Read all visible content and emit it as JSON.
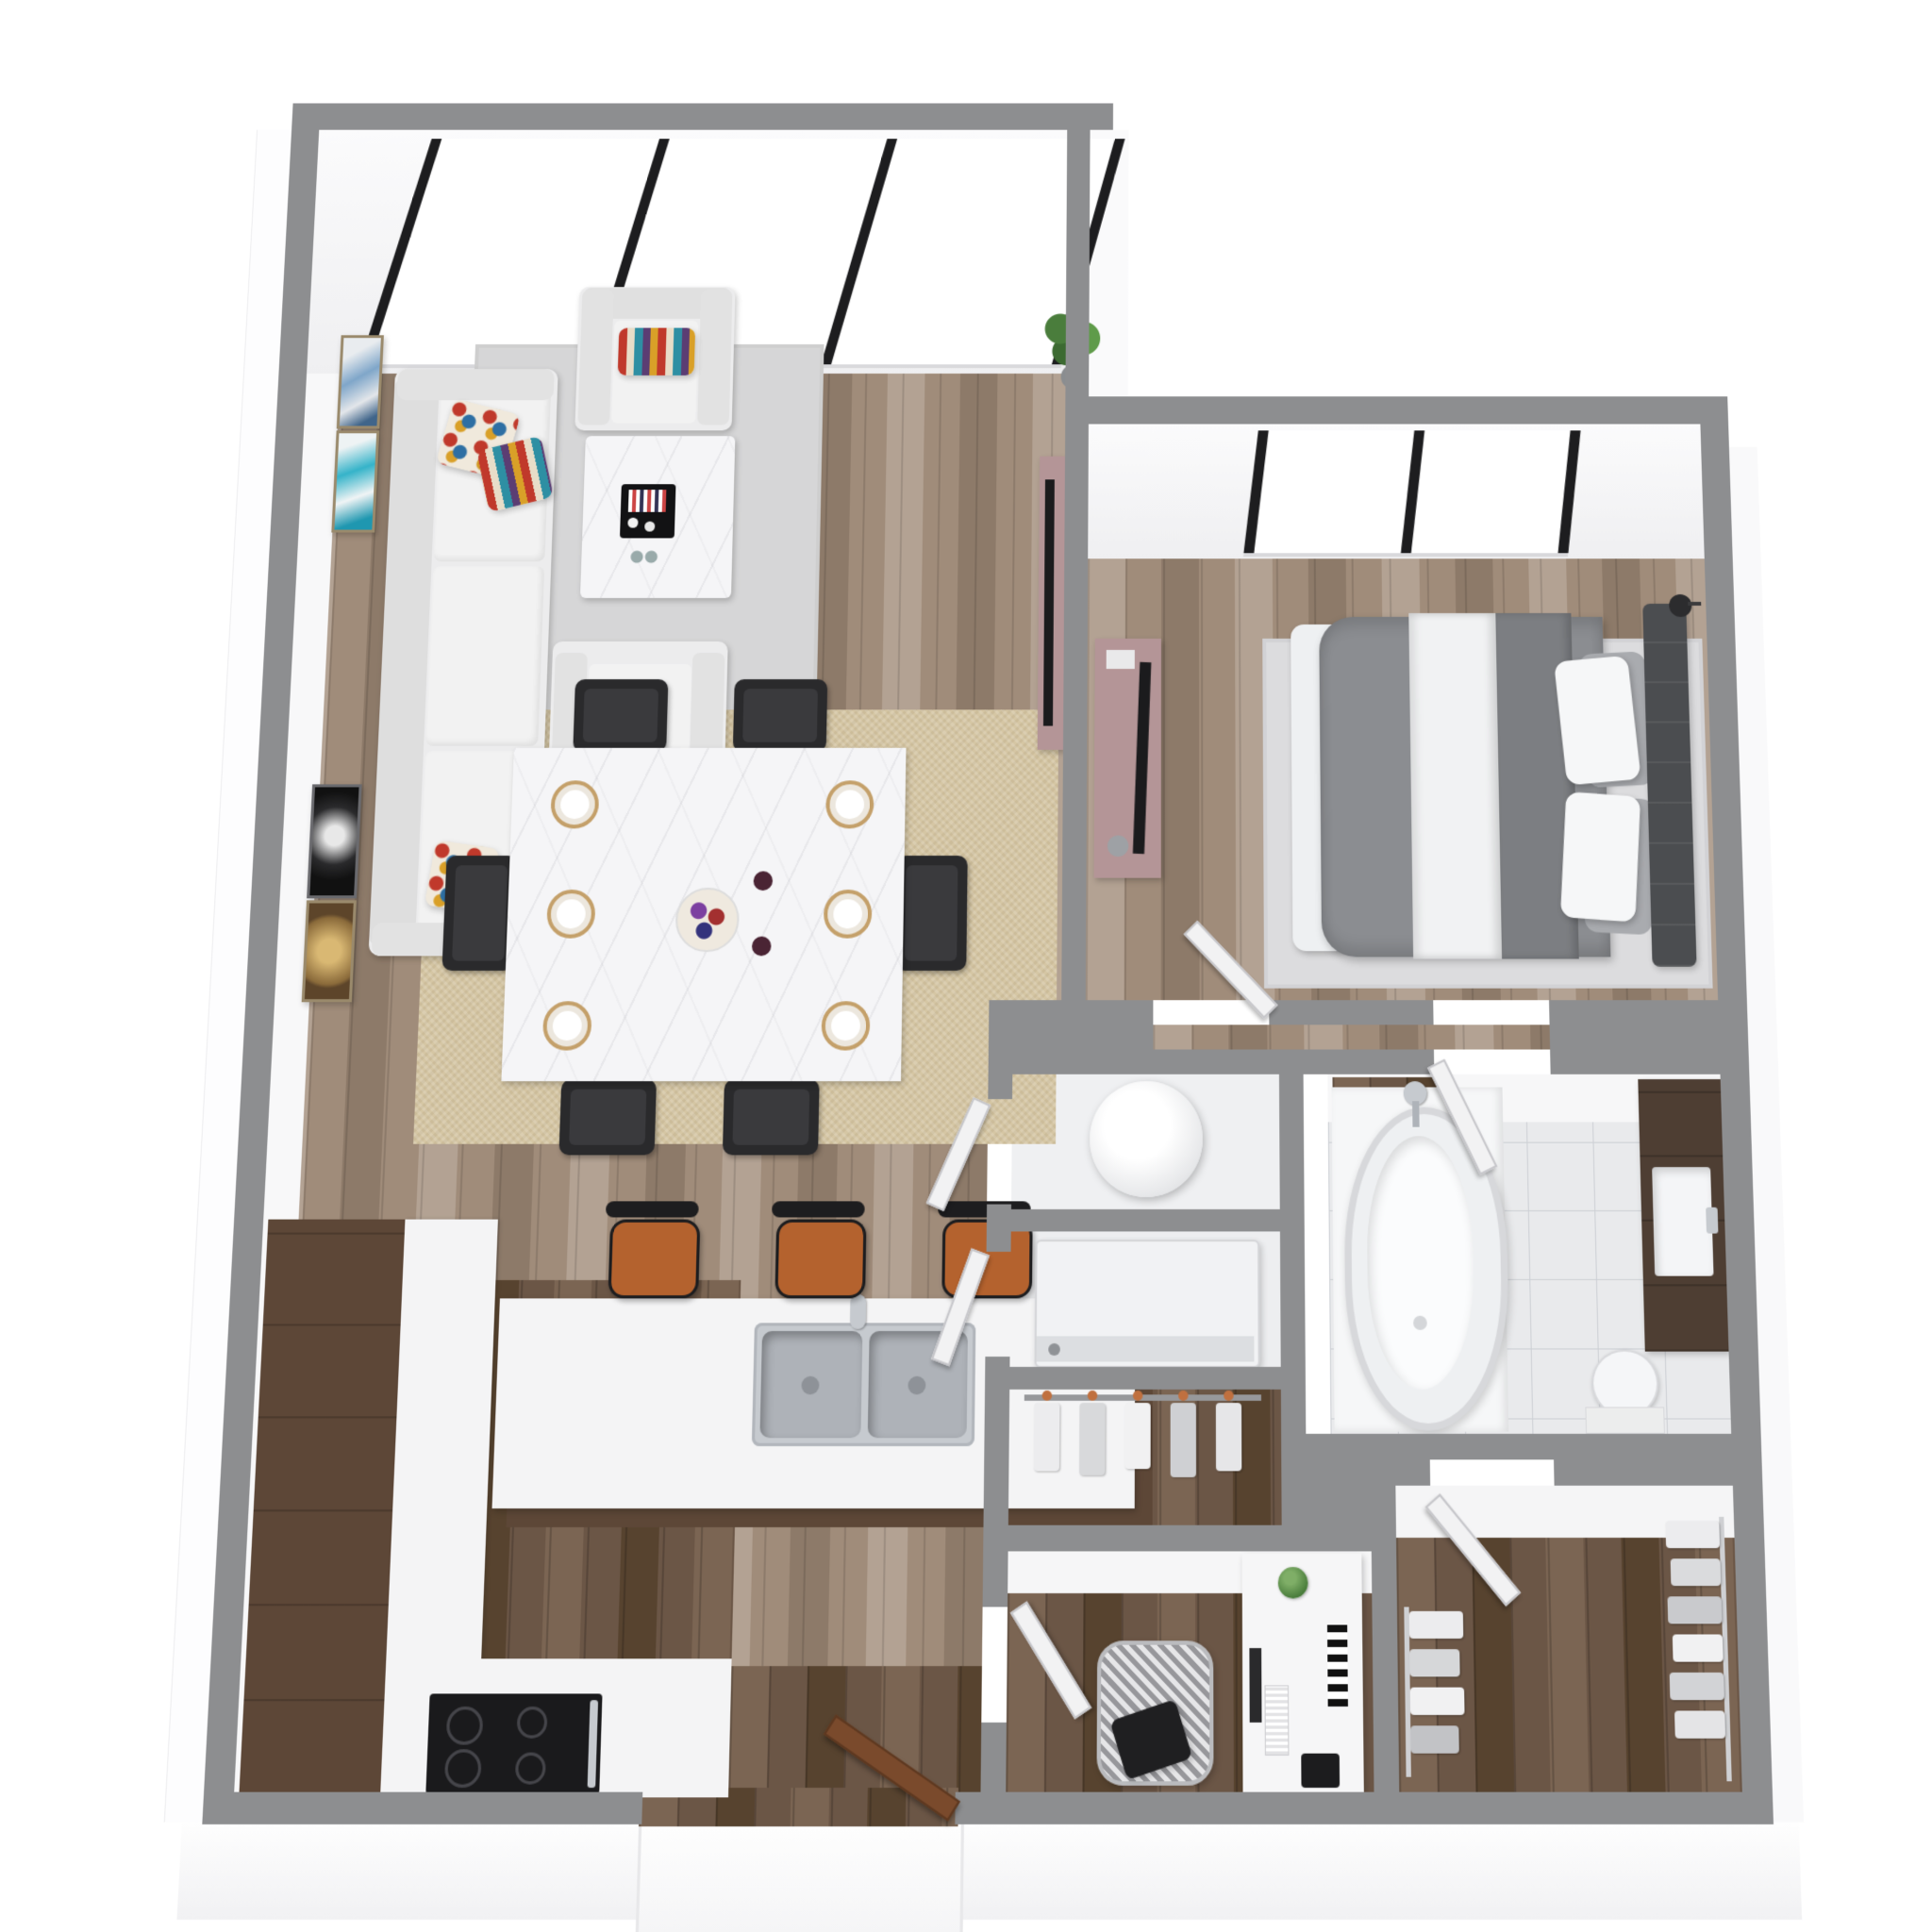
{
  "meta": {
    "scene": "3D rendered apartment floor plan, top-down dollhouse view",
    "background": "#ffffff"
  },
  "palette": {
    "wall": "#8d8e90",
    "wallFace": "#f7f7f8",
    "floorWood": "#a08c7a",
    "floorWoodLight": "#b3a293",
    "floorWoodDark": "#8d7a69",
    "kitchenWood": "#6b5646",
    "tile": "#e9eaec",
    "tileLine": "#cdd0d5",
    "rugGray": "#d6d6d7",
    "rugJute": "#d5c6a4",
    "rugBedroom": "#dcdcde",
    "upholstery": "#ececed",
    "marble": "#f5f5f7",
    "chairBlack": "#2a2a2c",
    "stoolOrange": "#b4622e",
    "mauve": "#b49597",
    "tvBlack": "#1b1b1d",
    "steel": "#c6cacf",
    "doorWhite": "#f2f2f3",
    "doorBrown": "#7a4a2c",
    "duvet": "#8b8d91",
    "duvetDark": "#7c7e82",
    "headboard": "#4b4d50",
    "pillowWhite": "#f6f7f8",
    "pillowGray": "#a9abaf",
    "plantGreen": "#4a7d3c",
    "gold": "#c4a06a",
    "cooktop": "#1a1a1c",
    "vanityWood": "#4e3e33",
    "glassFrame": "#1d1d1f"
  },
  "windows": {
    "living_room_panes": 3,
    "bedroom_panes": 2
  },
  "doors": {
    "interior_white_count": 7,
    "entry_wood_count": 1
  },
  "rooms": [
    {
      "name": "living-room",
      "items": [
        "sofa",
        "accent-pillows",
        "armchair-north",
        "armchair-south",
        "coffee-table",
        "black-tray-decor",
        "gray-area-rug",
        "tv-console",
        "television",
        "potted-plant",
        "wall-art-frames"
      ]
    },
    {
      "name": "dining-area",
      "items": [
        "marble-dining-table",
        "gold-place-settings-x6",
        "fruit-bowl",
        "black-dining-chairs-x6",
        "jute-rug"
      ]
    },
    {
      "name": "kitchen",
      "items": [
        "l-shaped-counter",
        "black-cooktop-oven",
        "island-with-wood-base",
        "stainless-double-sink",
        "orange-bar-stools-x3"
      ]
    },
    {
      "name": "bedroom",
      "items": [
        "bed-gray-duvet",
        "white-pillows",
        "tufted-headboard",
        "light-gray-rug",
        "tv-console",
        "television",
        "reading-lamp",
        "two-pane-window"
      ]
    },
    {
      "name": "bathroom",
      "items": [
        "freestanding-oval-tub",
        "chrome-tub-faucet",
        "wood-mat",
        "dark-wood-vanity",
        "rectangular-sink",
        "toilet",
        "marble-tile-floor"
      ]
    },
    {
      "name": "laundry-utility",
      "items": [
        "water-heater-cylinder",
        "washer",
        "hanging-rack-with-clothes"
      ]
    },
    {
      "name": "office-nook",
      "items": [
        "white-desk",
        "monitor",
        "keyboard",
        "houndstooth-task-chair",
        "black-cushion",
        "green-vase",
        "black-bag"
      ]
    },
    {
      "name": "walk-in-closet",
      "items": [
        "hanging-clothes-left-rail",
        "hanging-clothes-right-rail"
      ]
    },
    {
      "name": "entry",
      "items": [
        "open-wood-front-door",
        "recessed-vestibule"
      ]
    }
  ]
}
